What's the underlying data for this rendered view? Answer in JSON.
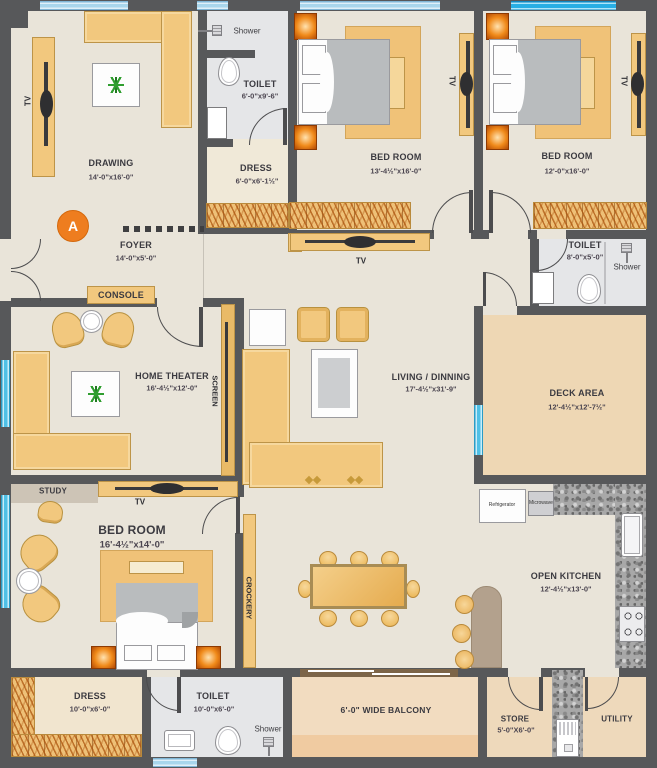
{
  "marker": "A",
  "labels": {
    "tv": "TV",
    "shower": "Shower",
    "console": "CONSOLE",
    "screen": "SCREEN",
    "study": "STUDY",
    "crockery": "CROCKERY",
    "refrigerator": "Refrigerator",
    "microwave": "Microwave"
  },
  "rooms": {
    "drawing": {
      "name": "DRAWING",
      "dims": "14'-0\"x16'-0\""
    },
    "toilet1": {
      "name": "TOILET",
      "dims": "6'-0\"x9'-6\""
    },
    "dress1": {
      "name": "DRESS",
      "dims": "6'-0\"x6'-1½\""
    },
    "bedroom1": {
      "name": "BED ROOM",
      "dims": "13'-4½\"x16'-0\""
    },
    "bedroom2": {
      "name": "BED ROOM",
      "dims": "12'-0\"x16'-0\""
    },
    "toilet2": {
      "name": "TOILET",
      "dims": "8'-0\"x5'-0\""
    },
    "deck": {
      "name": "DECK AREA",
      "dims": "12'-4½\"x12'-7½\""
    },
    "foyer": {
      "name": "FOYER",
      "dims": "14'-0\"x5'-0\""
    },
    "home_theater": {
      "name": "HOME THEATER",
      "dims": "16'-4½\"x12'-0\""
    },
    "living": {
      "name": "LIVING / DINNING",
      "dims": "17'-4½\"x31'-9\""
    },
    "bedroom3": {
      "name": "BED ROOM",
      "dims": "16'-4½\"x14'-0\""
    },
    "dress2": {
      "name": "DRESS",
      "dims": "10'-0\"x6'-0\""
    },
    "toilet3": {
      "name": "TOILET",
      "dims": "10'-0\"x6'-0\""
    },
    "balcony": {
      "name": "6'-0\" WIDE BALCONY"
    },
    "store": {
      "name": "STORE",
      "dims": "5'-0\"X6'-0\""
    },
    "utility": {
      "name": "UTILITY"
    },
    "kitchen": {
      "name": "OPEN KITCHEN",
      "dims": "12'-4½\"x13'-0\""
    }
  },
  "colors": {
    "wall": "#57585a",
    "floor": "#e9e4d9",
    "deck_floor": "#eed7b4",
    "toilet_floor": "#e5e6e8",
    "furniture": "#f2c87e",
    "accent_orange": "#ee7d1f",
    "window_blue": "#a8d6ec",
    "window_cyan": "#27aee4"
  }
}
